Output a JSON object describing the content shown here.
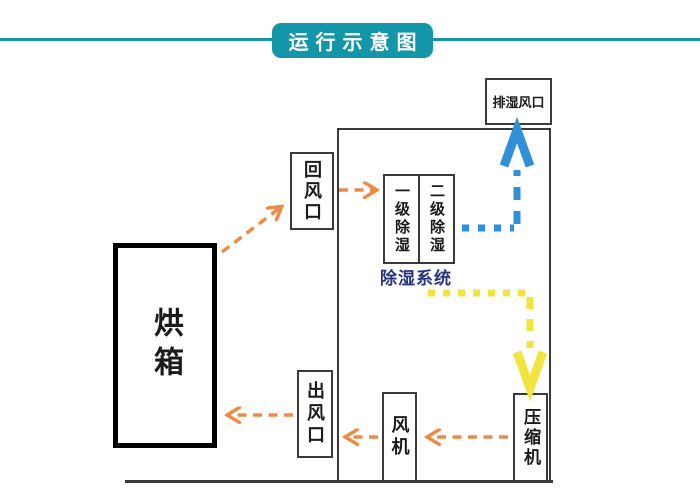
{
  "title": "运行示意图",
  "labels": {
    "oven": "烘箱",
    "return_air_vent": "回风口",
    "stage1": "一级除湿",
    "stage2": "二级除湿",
    "dehumid_system": "除湿系统",
    "exhaust_vent": "排湿风口",
    "air_outlet": "出风口",
    "fan": "风机",
    "compressor": "压缩机"
  },
  "colors": {
    "teal": "#1496a9",
    "orange": "#ef8a45",
    "blue": "#2f8fd8",
    "yellow": "#f2e43e",
    "navy": "#27357e",
    "line": "#3a3a3a"
  },
  "flows": [
    {
      "from": "烘箱",
      "to": "回风口",
      "style": "orange-dashed"
    },
    {
      "from": "回风口",
      "to": "一级除湿",
      "style": "orange-dashed"
    },
    {
      "from": "二级除湿",
      "to": "排湿风口",
      "style": "blue-dotted"
    },
    {
      "from": "除湿系统",
      "to": "压缩机",
      "style": "yellow-dotted"
    },
    {
      "from": "压缩机",
      "to": "风机",
      "style": "orange-dashed"
    },
    {
      "from": "风机",
      "to": "出风口",
      "style": "orange-dashed"
    },
    {
      "from": "出风口",
      "to": "烘箱",
      "style": "orange-dashed"
    }
  ]
}
